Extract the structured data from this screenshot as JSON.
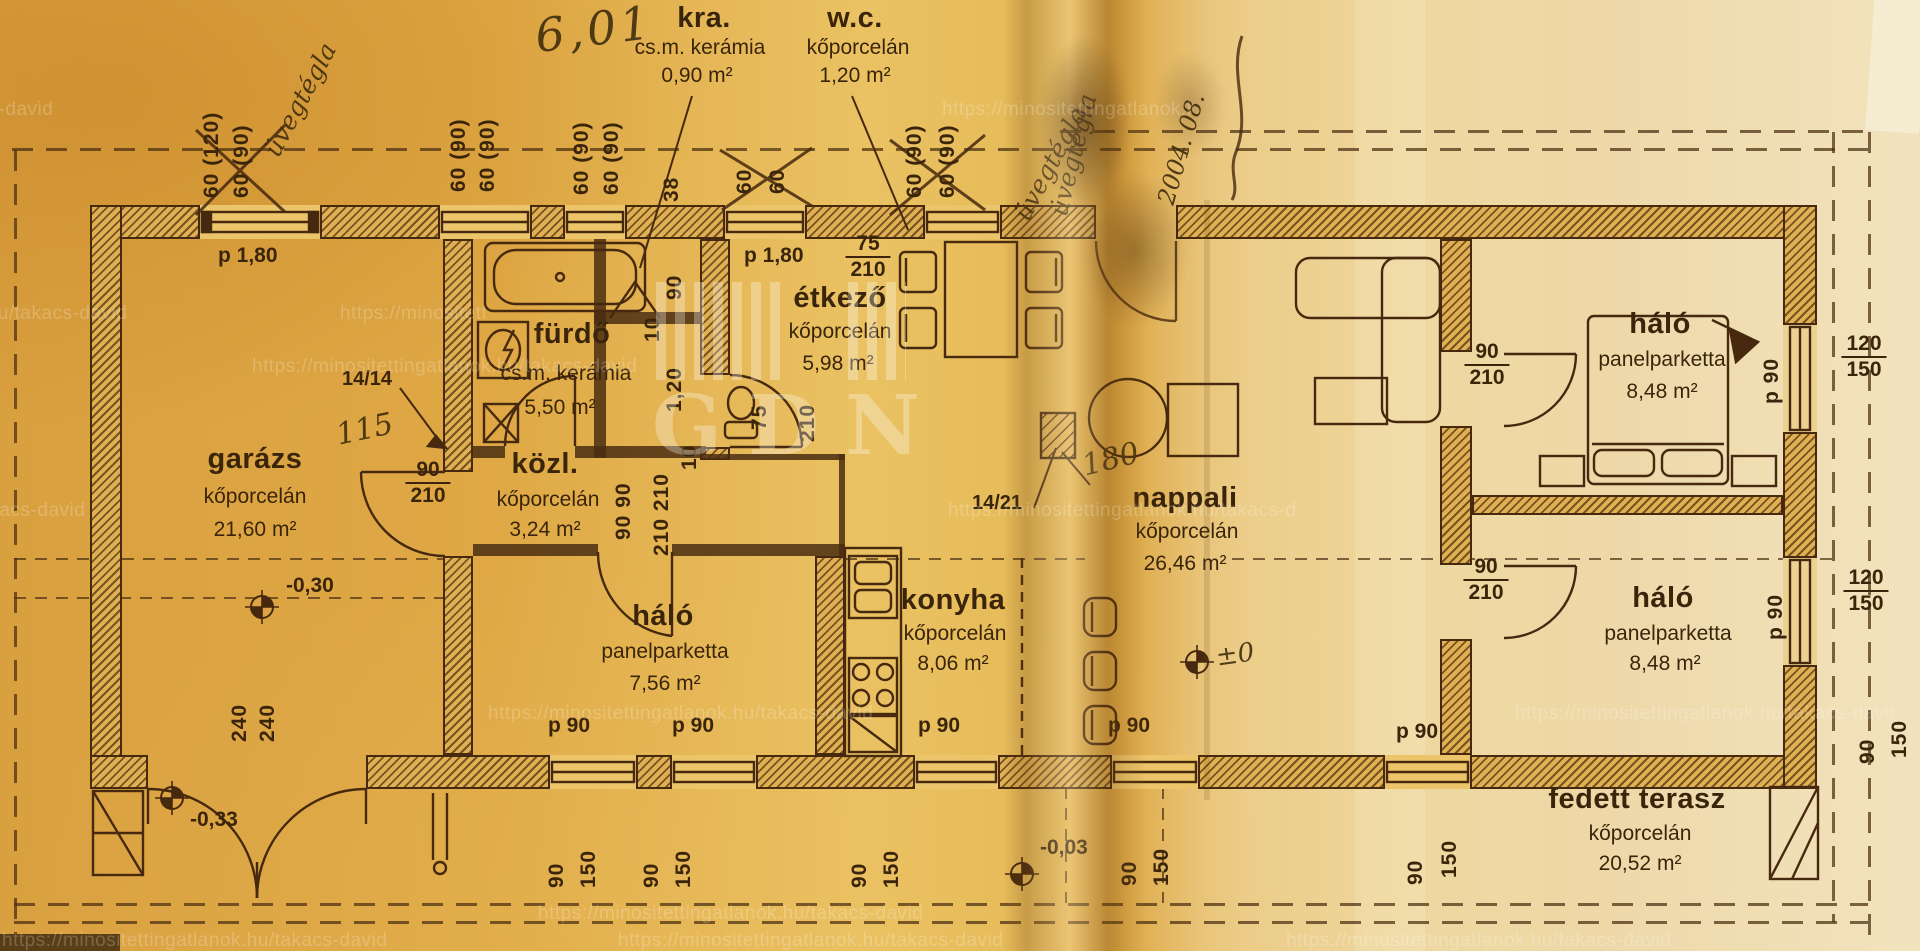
{
  "watermark": {
    "url": "https://minositettingatlanok.hu/takacs-david",
    "logo": "GDN"
  },
  "rooms": {
    "garazs": {
      "name": "garázs",
      "material": "kőporcelán",
      "area": "21,60 m²"
    },
    "furdo": {
      "name": "fürdő",
      "material": "cs.m. kerámia",
      "area": "5,50 m²"
    },
    "kozl": {
      "name": "közl.",
      "material": "kőporcelán",
      "area": "3,24 m²"
    },
    "kra": {
      "name": "kra.",
      "material": "cs.m. kerámia",
      "area": "0,90 m²"
    },
    "wc": {
      "name": "w.c.",
      "material": "kőporcelán",
      "area": "1,20 m²"
    },
    "etkezo": {
      "name": "étkező",
      "material": "kőporcelán",
      "area": "5,98 m²"
    },
    "nappali": {
      "name": "nappali",
      "material": "kőporcelán",
      "area": "26,46 m²"
    },
    "konyha": {
      "name": "konyha",
      "material": "kőporcelán",
      "area": "8,06 m²"
    },
    "halo_kozep": {
      "name": "háló",
      "material": "panelparketta",
      "area": "7,56 m²"
    },
    "halo_felso": {
      "name": "háló",
      "material": "panelparketta",
      "area": "8,48 m²"
    },
    "halo_also": {
      "name": "háló",
      "material": "panelparketta",
      "area": "8,48 m²"
    },
    "terasz": {
      "name": "fedett terasz",
      "material": "kőporcelán",
      "area": "20,52 m²"
    }
  },
  "levels": {
    "garazs": "-0,30",
    "garazs_kint": "-0,33",
    "terasz_kint": "-0,03",
    "foszint": "±0"
  },
  "refs": {
    "fal": "14/14",
    "kemeny": "14/21"
  },
  "handwritten": {
    "osszeg": "6,01",
    "uvegtegla": "üvegtégla",
    "datum": "2004. 08.",
    "fal_meret": "115",
    "kemeny_meret": "180"
  },
  "dims": {
    "d60_120": "60 (120)",
    "d60_90": "60 (90)",
    "d60": "60",
    "d38": "38",
    "d10": "10",
    "d75": "75",
    "d90": "90",
    "d120": "120",
    "d150": "150",
    "d210": "210",
    "d240": "240",
    "d1_20": "1,20",
    "d90_90": "90  90",
    "d210_210": "210  210",
    "p90": "p 90",
    "p180": "p 1,80"
  }
}
